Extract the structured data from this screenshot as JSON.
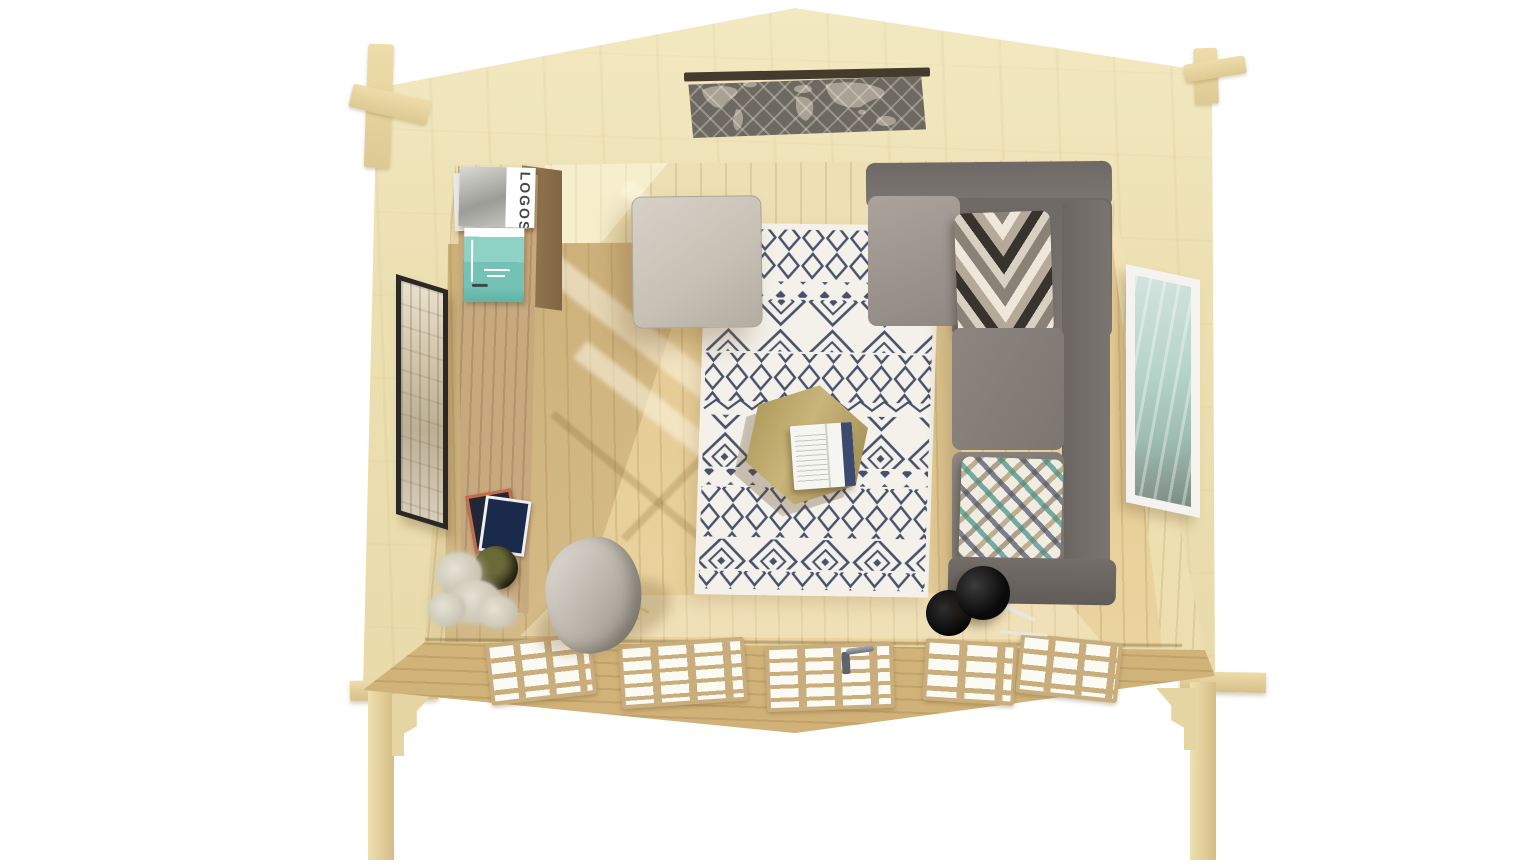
{
  "meta": {
    "type": "3d-render",
    "view": "birds-eye cutaway",
    "description": "Top-down view of a timber log cabin garden room furnished as a lounge",
    "background_color": "#ffffff"
  },
  "palette": {
    "wall_top_wood": "#ece0b2",
    "interior_wall_wood": "#efe2b8",
    "floor_wood": "#e5cc95",
    "front_wall_wood": "#dabe87",
    "glazing_white": "#fbfaf3",
    "shelf_oak": "#c8a97e",
    "sofa_gray": "#7d7773",
    "seat_gray": "#8d8680",
    "ottoman_gray": "#ccc5bb",
    "rug_base": "#f4f1ea",
    "rug_pattern_navy": "#47516b",
    "table_wood": "#c9b579",
    "poster_teal": "#8ed2c6",
    "art_right_teal": "#b6d3ca",
    "lamp_black": "#0d0d0d",
    "map_panel": "#6e6960",
    "map_land": "#b2a99a"
  },
  "objects": {
    "map_panel": {
      "label": "world-map panel in rear gable opening"
    },
    "shelf": {
      "label": "tall oak shelf unit along left wall"
    },
    "magazine": {
      "title": "LOGOS"
    },
    "poster": {
      "label": "teal sailboat poster on shelf"
    },
    "wall_art_left": {
      "label": "dark-framed architecture print on left wall"
    },
    "wall_art_right": {
      "label": "white-framed ocean print on right wall"
    },
    "ottoman": {
      "label": "square light-gray ottoman"
    },
    "rug": {
      "label": "white and navy berber-pattern rug"
    },
    "coffee_table": {
      "label": "hexagonal wooden coffee table"
    },
    "open_book": {
      "label": "open magazine on the table"
    },
    "sofa": {
      "label": "gray L-shaped corner sofa"
    },
    "pillow_chevron": {
      "label": "chevron-pattern cushion"
    },
    "pillow_mosaic": {
      "label": "teal mosaic-pattern cushion"
    },
    "floor_lamp": {
      "label": "black floor lamp"
    },
    "lounge_chair": {
      "label": "gray lounge chair with wooden legs"
    },
    "plant": {
      "label": "dried flowers in a dark pot"
    },
    "photos": {
      "label": "stack of photo prints"
    },
    "front_wall": {
      "label": "glazed doors and windows",
      "pane_groups": 5,
      "door_handle": true
    }
  }
}
